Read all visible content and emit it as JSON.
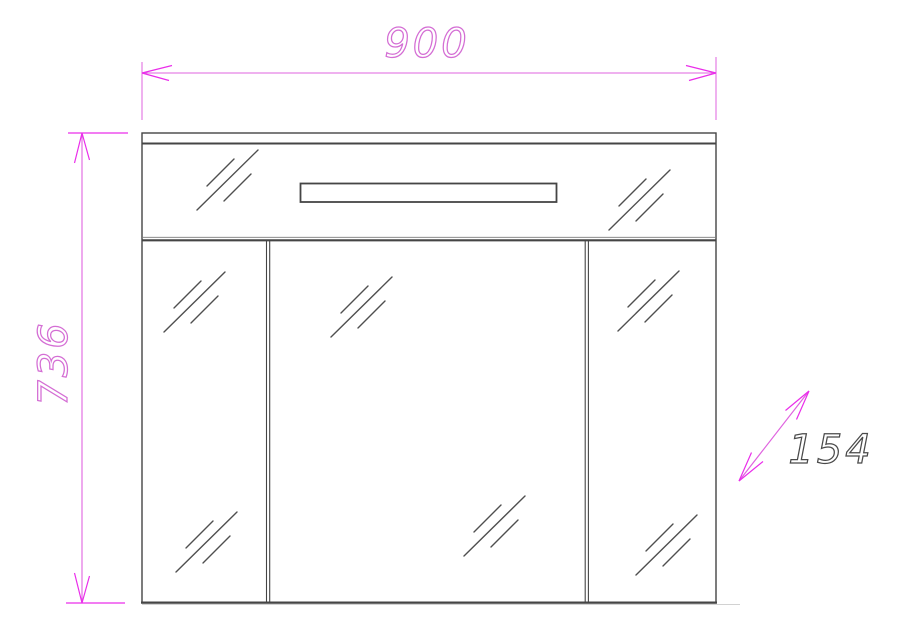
{
  "drawing": {
    "title": "mirror-cabinet-front-elevation",
    "dimensions": {
      "width_label": "900",
      "height_label": "736",
      "depth_label": "154"
    },
    "colors": {
      "dimension_line": "#df63df",
      "dimension_arrow": "#ea2dea",
      "dimension_text_outline": "#d46ed4",
      "depth_text_outline": "#4a4a4a",
      "drawing_line": "#454545",
      "light_line": "#9a9a9a",
      "background": "#ffffff"
    }
  }
}
